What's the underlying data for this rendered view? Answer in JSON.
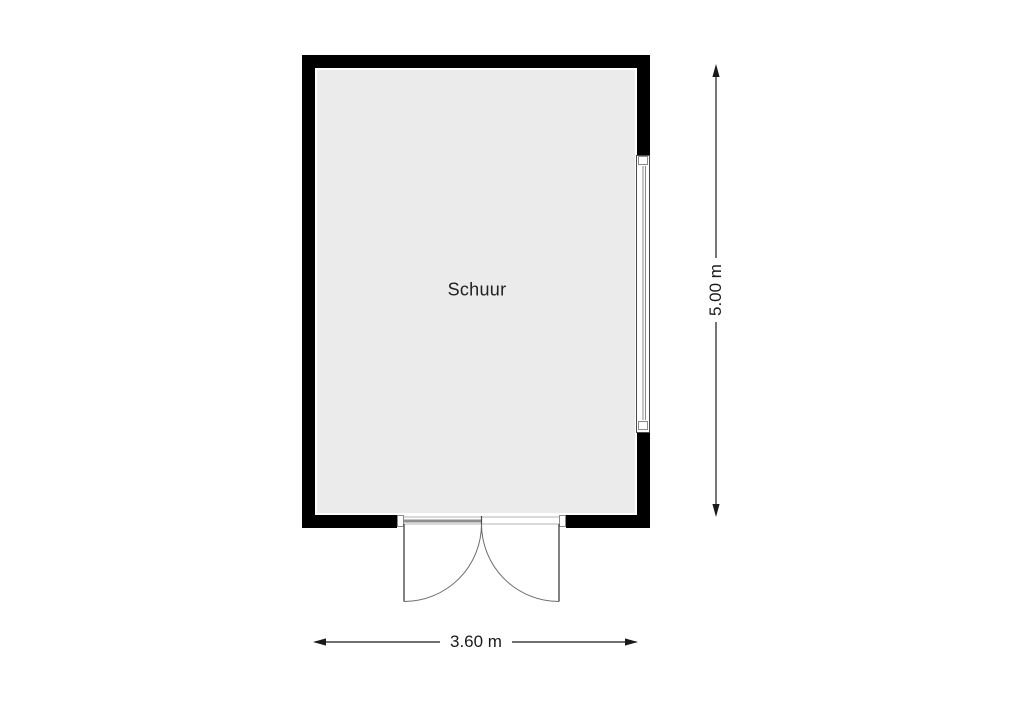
{
  "floorplan": {
    "room_label": "Schuur",
    "dimensions": {
      "height_label": "5.00 m",
      "width_label": "3.60 m"
    },
    "colors": {
      "wall": "#000000",
      "floor": "#ebebeb",
      "line": "#5f5f5f",
      "dim": "#1a1a1a"
    },
    "features": {
      "window": "window-right-wall",
      "door": "double-door-bottom-swing-out"
    }
  }
}
